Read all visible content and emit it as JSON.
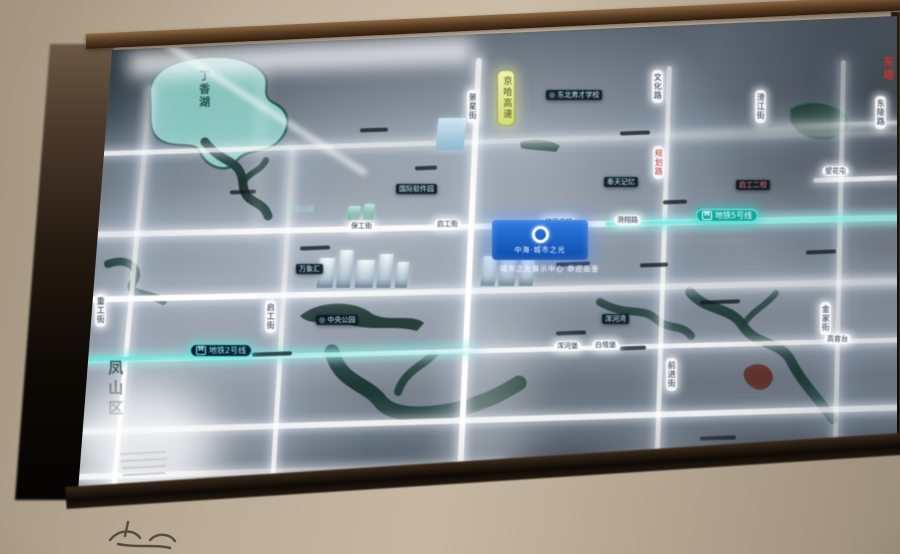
{
  "scene": {
    "subject": "illuminated real-estate location map board on a wall",
    "colors": {
      "wall": "#b8a995",
      "frame": "#5c3f24",
      "panel": "#79828e",
      "road_glow": "#ffffff",
      "metro_teal": "#54e4da",
      "water": "#16332c",
      "lake": "#8ecfc6",
      "badge_blue": "#1b5fc4",
      "highway_yellow": "#dfe48c",
      "red_accent": "#c03428"
    }
  },
  "map": {
    "project": {
      "name": "中海·城市之光",
      "tagline": "城市之光展示中心 恭迎品鉴"
    },
    "metro_icon": "M",
    "district_label": "凤山区",
    "lake_label": "丁香湖",
    "labels": [
      {
        "kind": "pill-v",
        "x": 467,
        "y": 90,
        "text": "景星街"
      },
      {
        "kind": "pill-v",
        "x": 652,
        "y": 70,
        "text": "文化路"
      },
      {
        "kind": "pill-v",
        "x": 755,
        "y": 90,
        "text": "滂江街"
      },
      {
        "kind": "pill-v",
        "x": 875,
        "y": 96,
        "text": "东陵路"
      },
      {
        "kind": "pill-v-red",
        "x": 653,
        "y": 146,
        "text": "规划路"
      },
      {
        "kind": "pill-v",
        "x": 265,
        "y": 300,
        "text": "启工街"
      },
      {
        "kind": "pill-v",
        "x": 95,
        "y": 294,
        "text": "重工街"
      },
      {
        "kind": "pill-v",
        "x": 666,
        "y": 358,
        "text": "前进街"
      },
      {
        "kind": "pill-v",
        "x": 820,
        "y": 302,
        "text": "金家街"
      },
      {
        "kind": "pill-yellow",
        "x": 497,
        "y": 70,
        "text": "京哈高速"
      },
      {
        "kind": "pill-h",
        "x": 348,
        "y": 221,
        "text": "保工街"
      },
      {
        "kind": "pill-h",
        "x": 434,
        "y": 219,
        "text": "启工街"
      },
      {
        "kind": "pill-h",
        "x": 542,
        "y": 217,
        "text": "铁西广场"
      },
      {
        "kind": "pill-h",
        "x": 614,
        "y": 215,
        "text": "滑翔路"
      },
      {
        "kind": "pill-h",
        "x": 822,
        "y": 166,
        "text": "望花屯"
      },
      {
        "kind": "pill-h",
        "x": 554,
        "y": 341,
        "text": "浑河堡"
      },
      {
        "kind": "pill-h",
        "x": 592,
        "y": 340,
        "text": "白塔堡"
      },
      {
        "kind": "pill-h",
        "x": 824,
        "y": 334,
        "text": "高官台"
      },
      {
        "kind": "metro2",
        "x": 190,
        "y": 344,
        "text": "地铁2号线"
      },
      {
        "kind": "metro5",
        "x": 696,
        "y": 209,
        "text": "地铁5号线"
      },
      {
        "kind": "plate",
        "x": 546,
        "y": 90,
        "text": "◎ 东北育才学校"
      },
      {
        "kind": "plate",
        "x": 396,
        "y": 184,
        "text": "国际软件园"
      },
      {
        "kind": "plate",
        "x": 604,
        "y": 177,
        "text": "奉天记忆"
      },
      {
        "kind": "plate-red",
        "x": 736,
        "y": 180,
        "text": "启工二校"
      },
      {
        "kind": "plate",
        "x": 602,
        "y": 314,
        "text": "浑河湾"
      },
      {
        "kind": "plate",
        "x": 316,
        "y": 315,
        "text": "◎ 中央公园"
      },
      {
        "kind": "plate",
        "x": 296,
        "y": 264,
        "text": "万象汇"
      },
      {
        "kind": "lake-name",
        "x": 197,
        "y": 70,
        "text": "丁香湖"
      },
      {
        "kind": "district",
        "x": 106,
        "y": 360,
        "text": "凤山区"
      },
      {
        "kind": "park-label",
        "x": 286,
        "y": 205,
        "text": "劳动公园"
      },
      {
        "kind": "red-v",
        "x": 881,
        "y": 56,
        "text": "东塔"
      }
    ],
    "geo": {
      "roads": [
        {
          "d": "h",
          "x": 75,
          "y": 152,
          "w": 828,
          "h": 5,
          "rot": -1.8,
          "op": 0.85,
          "fade": "right"
        },
        {
          "d": "h",
          "x": 75,
          "y": 232,
          "w": 828,
          "h": 6,
          "rot": -1.2,
          "op": 0.95,
          "fade": "none"
        },
        {
          "d": "h",
          "x": 75,
          "y": 297,
          "w": 828,
          "h": 6,
          "rot": -1.3,
          "op": 1,
          "fade": "right-soft"
        },
        {
          "d": "h",
          "x": 75,
          "y": 359,
          "w": 828,
          "h": 5,
          "rot": -1.5,
          "op": 0.9,
          "fade": "none"
        },
        {
          "d": "h",
          "x": 75,
          "y": 429,
          "w": 832,
          "h": 6,
          "rot": -1.7,
          "op": 0.9,
          "fade": "none"
        },
        {
          "d": "h",
          "x": 75,
          "y": 474,
          "w": 430,
          "h": 6,
          "rot": -1.6,
          "op": 0.85,
          "fade": "right"
        },
        {
          "d": "h",
          "x": 760,
          "y": 124,
          "w": 142,
          "h": 4,
          "rot": -1.5,
          "op": 0.5,
          "fade": "left"
        },
        {
          "d": "h",
          "x": 813,
          "y": 178,
          "w": 92,
          "h": 5,
          "rot": -1.8,
          "op": 0.85,
          "fade": "none"
        },
        {
          "d": "v",
          "x": 148,
          "y": 86,
          "w": 5,
          "h": 414,
          "rot": 5.2,
          "op": 0.95,
          "fade": "topdim"
        },
        {
          "d": "v",
          "x": 290,
          "y": 148,
          "w": 5,
          "h": 350,
          "rot": 3.4,
          "op": 0.85,
          "fade": "topdim"
        },
        {
          "d": "v",
          "x": 476,
          "y": 58,
          "w": 6,
          "h": 438,
          "rot": 2.6,
          "op": 1,
          "fade": "vnone"
        },
        {
          "d": "v",
          "x": 667,
          "y": 66,
          "w": 5,
          "h": 426,
          "rot": 1.8,
          "op": 0.8,
          "fade": "vnone"
        },
        {
          "d": "v",
          "x": 841,
          "y": 60,
          "w": 5,
          "h": 396,
          "rot": 1.2,
          "op": 0.6,
          "fade": "vnone"
        }
      ],
      "metro": [
        {
          "x": 75,
          "y": 358,
          "w": 400,
          "rot": -1.5,
          "fade": "right"
        },
        {
          "x": 606,
          "y": 222,
          "w": 294,
          "rot": -1.2,
          "fade": "none"
        }
      ],
      "water": [
        {
          "name": "lake",
          "d": "M150,96 C148,74 168,62 196,58 C224,54 252,58 264,74 C272,85 258,96 276,104 C290,112 292,128 278,142 C266,154 244,148 236,162 C228,174 206,168 200,152 C194,140 176,150 160,140 C146,131 152,112 150,96 Z",
          "fill": "#8ecfc6",
          "stroke": "#1d4f48",
          "sw": 2.5,
          "op": 0.9
        },
        {
          "name": "river",
          "d": "M205,142 C224,166 241,158 243,184 C245,206 262,198 268,216",
          "stroke": "#16332c",
          "sw": 9,
          "op": 0.95
        },
        {
          "name": "river",
          "d": "M243,182 C252,170 260,172 266,160",
          "stroke": "#16332c",
          "sw": 6,
          "op": 0.9
        },
        {
          "name": "river",
          "d": "M108,264 C130,256 142,270 133,283 C125,295 150,293 163,301",
          "stroke": "#17332c",
          "sw": 8,
          "op": 0.9
        },
        {
          "name": "river-blob",
          "d": "M300,316 C320,299 356,301 371,313 C386,323 412,313 424,323 L417,331 C396,325 371,331 351,325 C331,319 310,327 300,316 Z",
          "fill": "#182f28",
          "op": 0.92
        },
        {
          "name": "river",
          "d": "M332,352 C341,384 366,382 381,402 C396,420 441,414 466,407 C491,400 506,391 519,383",
          "stroke": "#16332c",
          "sw": 15,
          "op": 0.95
        },
        {
          "name": "river",
          "d": "M398,392 C404,372 422,366 434,354",
          "stroke": "#16332c",
          "sw": 8,
          "op": 0.85
        },
        {
          "name": "river",
          "d": "M600,302 C626,317 641,306 656,319 C669,331 681,323 691,336",
          "stroke": "#17332c",
          "sw": 8,
          "op": 0.88
        },
        {
          "name": "river",
          "d": "M690,292 C706,312 731,306 743,326 C756,346 781,341 791,361 C801,381 816,396 833,419",
          "stroke": "#16332c",
          "sw": 10,
          "op": 0.92
        },
        {
          "name": "river",
          "d": "M743,326 C751,311 766,306 776,293",
          "stroke": "#16332c",
          "sw": 6,
          "op": 0.8
        },
        {
          "name": "red-grove",
          "d": "M745,369 C755,361 768,363 772,373 C776,383 765,393 755,389 C747,385 741,377 745,369 Z",
          "fill": "#5c241a",
          "op": 0.85
        },
        {
          "name": "park",
          "d": "M790,109 C805,99 831,101 845,113 C855,123 848,136 832,139 C812,143 795,133 790,121 Z",
          "fill": "#1a352c",
          "stroke": "#2f5a4c",
          "sw": 1.5,
          "op": 0.95
        },
        {
          "name": "pond",
          "d": "M520,142 C535,138 552,140 560,146 L556,152 C542,150 528,150 521,148 Z",
          "fill": "#1c3830",
          "op": 0.8
        }
      ],
      "buildings": [
        {
          "x": 318,
          "y": 258,
          "w": 16,
          "h": 30,
          "v": "a"
        },
        {
          "x": 338,
          "y": 250,
          "w": 14,
          "h": 38,
          "v": "a"
        },
        {
          "x": 356,
          "y": 260,
          "w": 18,
          "h": 28,
          "v": "a"
        },
        {
          "x": 378,
          "y": 254,
          "w": 14,
          "h": 34,
          "v": "a"
        },
        {
          "x": 396,
          "y": 262,
          "w": 12,
          "h": 26,
          "v": "a"
        },
        {
          "x": 482,
          "y": 256,
          "w": 14,
          "h": 30,
          "v": "a"
        },
        {
          "x": 500,
          "y": 250,
          "w": 16,
          "h": 36,
          "v": "a"
        },
        {
          "x": 520,
          "y": 258,
          "w": 14,
          "h": 28,
          "v": "a"
        },
        {
          "x": 437,
          "y": 118,
          "w": 28,
          "h": 32,
          "v": "b"
        },
        {
          "x": 348,
          "y": 206,
          "w": 12,
          "h": 14,
          "v": "t"
        },
        {
          "x": 364,
          "y": 204,
          "w": 10,
          "h": 16,
          "v": "t"
        }
      ],
      "glares": [
        {
          "x": 128,
          "y": 46,
          "w": 345,
          "h": 24,
          "rot": -2.4,
          "blur": 9,
          "op": 0.8
        },
        {
          "x": 92,
          "y": 90,
          "w": 298,
          "h": 5,
          "rot": 33,
          "blur": 3,
          "op": 0.75
        },
        {
          "x": 256,
          "y": 62,
          "w": 7,
          "h": 178,
          "rot": 3,
          "blur": 6,
          "op": 0.3
        },
        {
          "x": 66,
          "y": 384,
          "w": 150,
          "h": 120,
          "rot": 0,
          "blur": 20,
          "op": 0.75,
          "blob": true
        },
        {
          "x": 450,
          "y": 310,
          "w": 76,
          "h": 190,
          "rot": 1,
          "blur": 24,
          "op": 0.3
        },
        {
          "x": 600,
          "y": 444,
          "w": 130,
          "h": 50,
          "rot": -2,
          "blur": 20,
          "op": 0.28,
          "blob": true
        }
      ],
      "dashes": [
        {
          "x": 230,
          "y": 190,
          "w": 26
        },
        {
          "x": 415,
          "y": 166,
          "w": 22
        },
        {
          "x": 300,
          "y": 246,
          "w": 30
        },
        {
          "x": 556,
          "y": 262,
          "w": 34
        },
        {
          "x": 640,
          "y": 263,
          "w": 28
        },
        {
          "x": 700,
          "y": 300,
          "w": 40
        },
        {
          "x": 556,
          "y": 331,
          "w": 30
        },
        {
          "x": 620,
          "y": 346,
          "w": 26
        },
        {
          "x": 700,
          "y": 436,
          "w": 36
        },
        {
          "x": 560,
          "y": 456,
          "w": 40
        },
        {
          "x": 360,
          "y": 128,
          "w": 28
        },
        {
          "x": 620,
          "y": 131,
          "w": 30
        },
        {
          "x": 252,
          "y": 352,
          "w": 40
        },
        {
          "x": 663,
          "y": 200,
          "w": 24
        },
        {
          "x": 806,
          "y": 250,
          "w": 30
        }
      ],
      "hatches": [
        {
          "x": 120,
          "y": 452,
          "w": 46
        },
        {
          "x": 121,
          "y": 459,
          "w": 46
        },
        {
          "x": 122,
          "y": 466,
          "w": 44
        },
        {
          "x": 123,
          "y": 473,
          "w": 42
        }
      ]
    }
  }
}
